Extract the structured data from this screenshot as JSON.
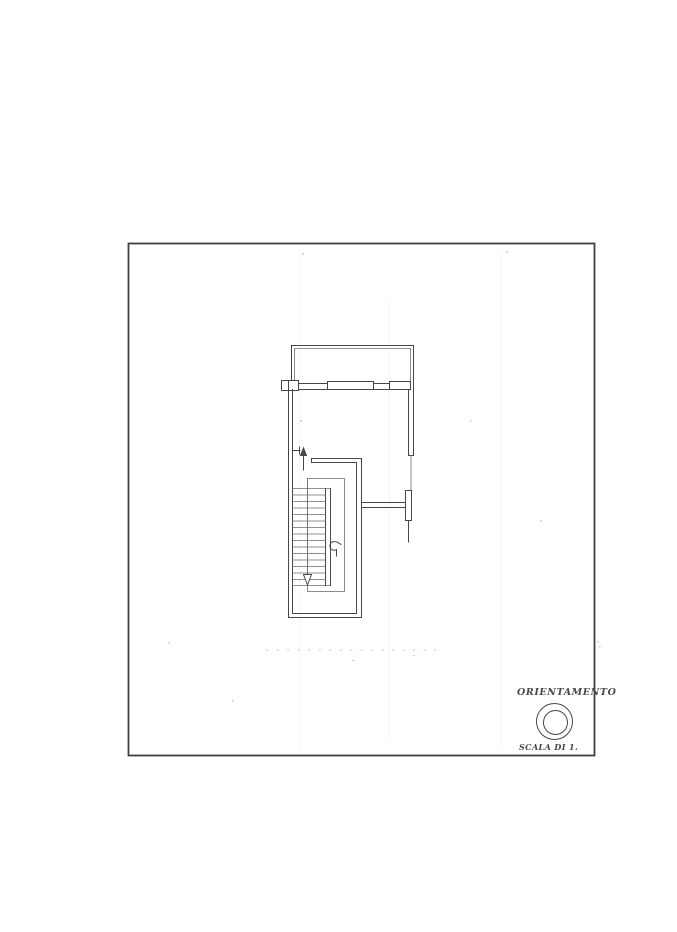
{
  "labels": {
    "orientation": "ORIENTAMENTO",
    "scale": "SCALA DI 1."
  },
  "icons": {
    "orientation_marker": "double-circle-icon",
    "entry_direction": "arrow-up-icon",
    "stair_direction": "arrow-down-icon",
    "walk_line_start": "curl-icon"
  },
  "colors": {
    "paper": "#ffffff",
    "ink": "#474747",
    "thin": "#6e6e6e",
    "frame": "#3f3f3f",
    "artifact": "#8a8a8a"
  }
}
